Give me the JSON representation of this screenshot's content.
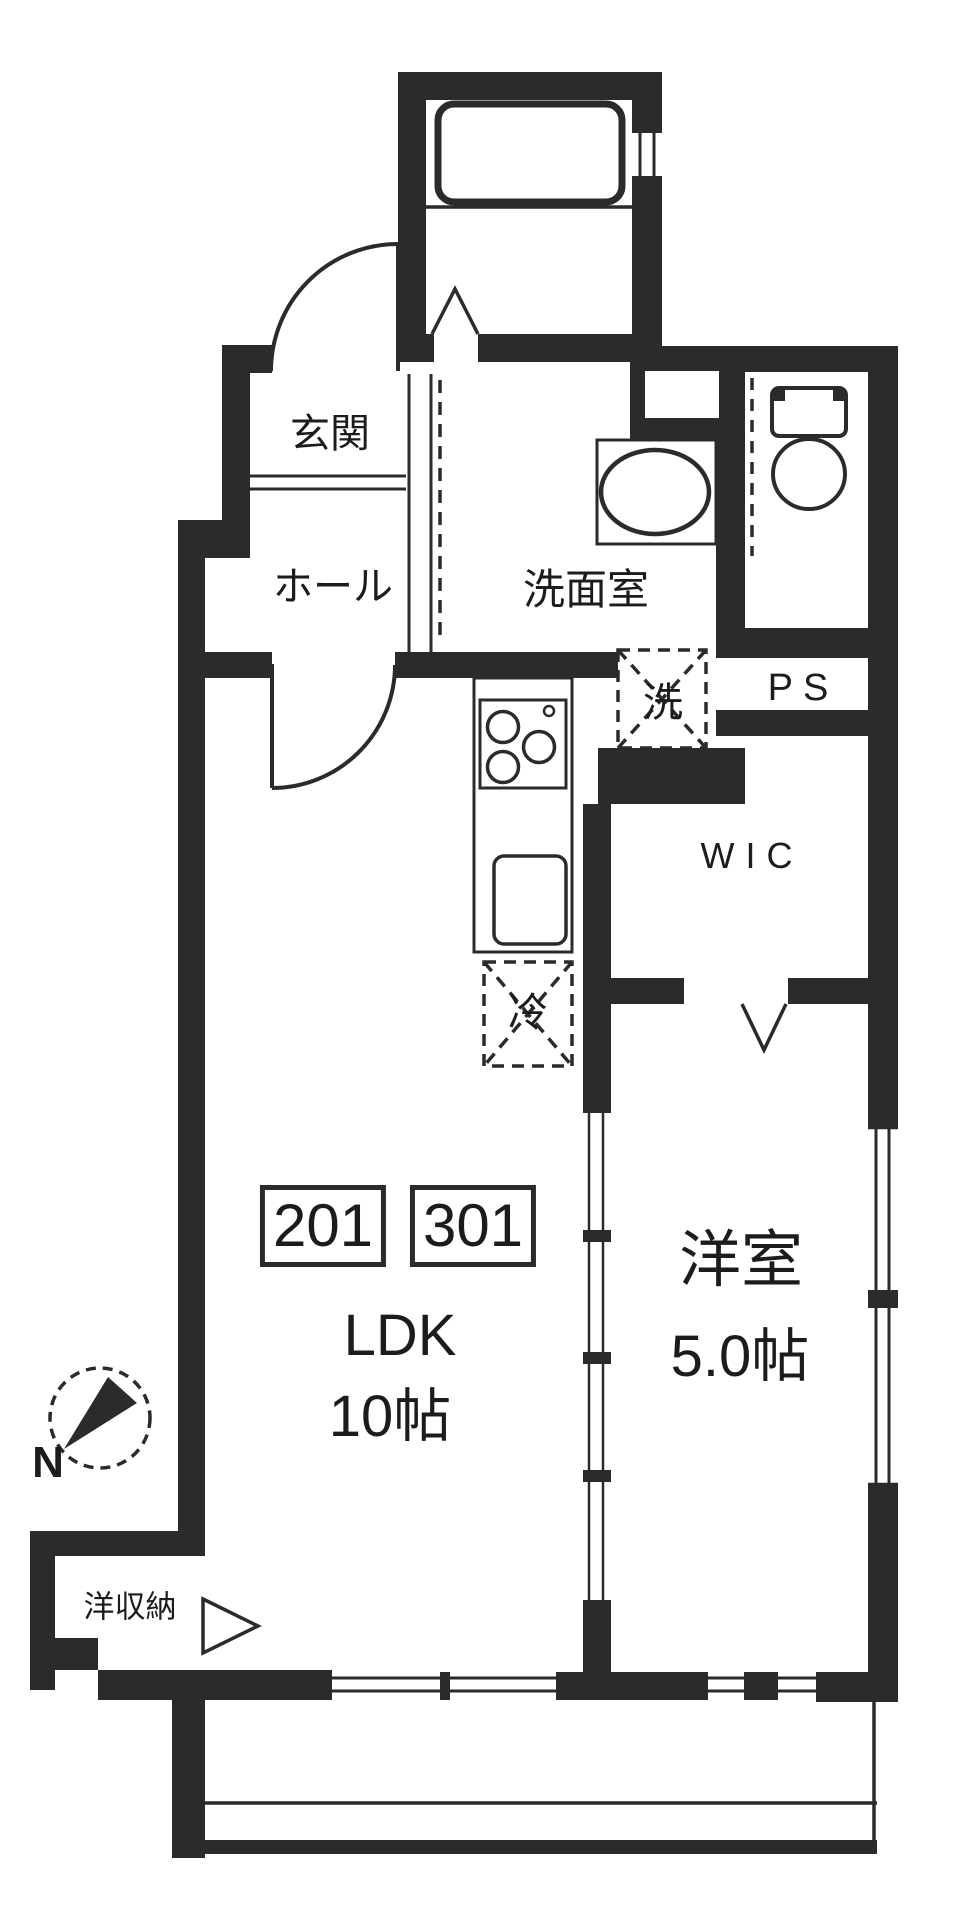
{
  "floorplan": {
    "unit_badges": {
      "left": "201",
      "right": "301"
    },
    "labels": {
      "entrance": "玄関",
      "hall": "ホール",
      "washroom": "洗面室",
      "washer": "洗",
      "pipe_space": "PS",
      "wic": "WIC",
      "fridge": "冷",
      "ldk_name": "LDK",
      "ldk_size": "10帖",
      "bedroom_name": "洋室",
      "bedroom_size": "5.0帖",
      "storage": "洋収納",
      "north": "N"
    },
    "colors": {
      "wall": "#2b2b2b",
      "ink": "#1c1c1c",
      "background": "#ffffff"
    }
  }
}
